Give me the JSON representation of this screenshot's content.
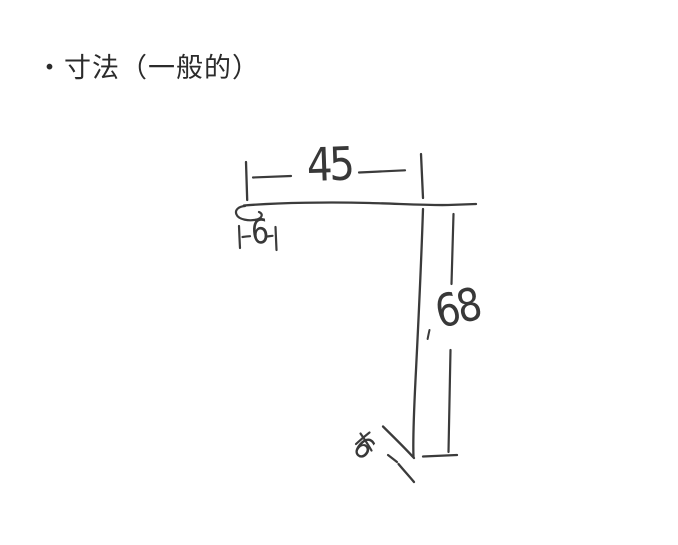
{
  "title": "・寸法（一般的）",
  "sketch": {
    "top_width": "45",
    "top_hem": "6",
    "side_height": "68",
    "bottom_hem": "6"
  },
  "colors": {
    "ink": "#3b3b3b",
    "paper": "#ffffff"
  }
}
